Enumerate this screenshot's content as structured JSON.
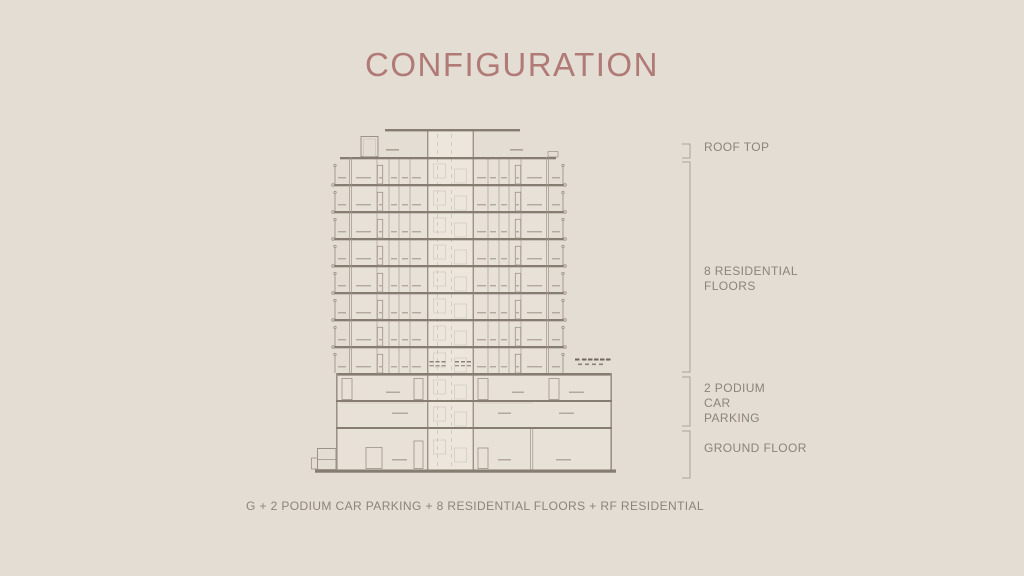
{
  "slide": {
    "title": "CONFIGURATION",
    "caption": "G + 2 PODIUM CAR PARKING + 8 RESIDENTIAL FLOORS + RF RESIDENTIAL",
    "annotations": {
      "roof": "ROOF TOP",
      "residential": "8 RESIDENTIAL FLOORS",
      "podium": "2 PODIUM CAR PARKING",
      "ground": "GROUND FLOOR"
    },
    "colors": {
      "background": "#e4ddd4",
      "title": "#b07b76",
      "label_text": "#8b847a",
      "bracket": "#aaa295",
      "drawing_line": "#9b9288",
      "drawing_slab": "#857c72"
    }
  },
  "diagram": {
    "residential_floors": 8,
    "podium_floors": 2,
    "ground_floors": 1,
    "roof_levels": 1
  }
}
